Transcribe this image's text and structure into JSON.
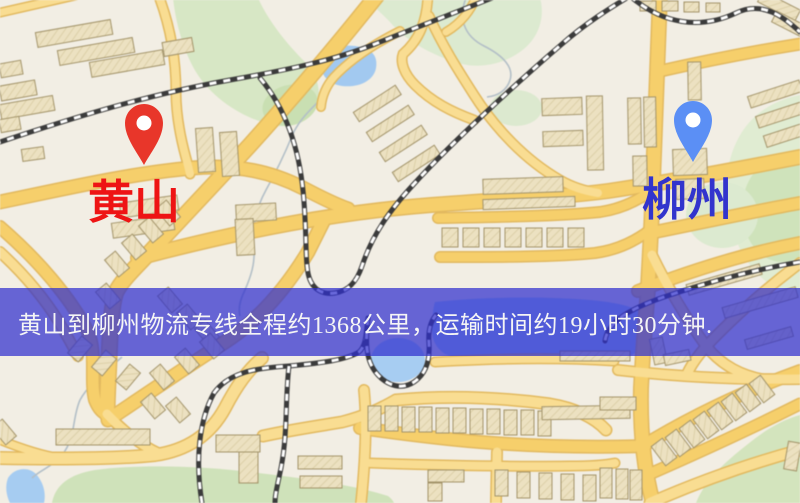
{
  "map": {
    "origin": {
      "label": "黄山",
      "label_color": "#ee1414",
      "pin_color": "#e8362a"
    },
    "destination": {
      "label": "柳州",
      "label_color": "#3234cd",
      "pin_color": "#5b8ff5"
    }
  },
  "banner": {
    "text": "黄山到柳州物流专线全程约1368公里，运输时间约19小时30分钟.",
    "background_color": "rgba(47,47,205,0.72)",
    "text_color": "#f5f5f5"
  },
  "palette": {
    "map_background": "#f2eee4",
    "road_main": "#f6cf6b",
    "road_minor": "#f9dd92",
    "road_casing": "#e2b95f",
    "railway": "#3b3b3b",
    "water": "#a7cdf2",
    "park": "#d7e7c5",
    "building": "#ece1c1"
  }
}
